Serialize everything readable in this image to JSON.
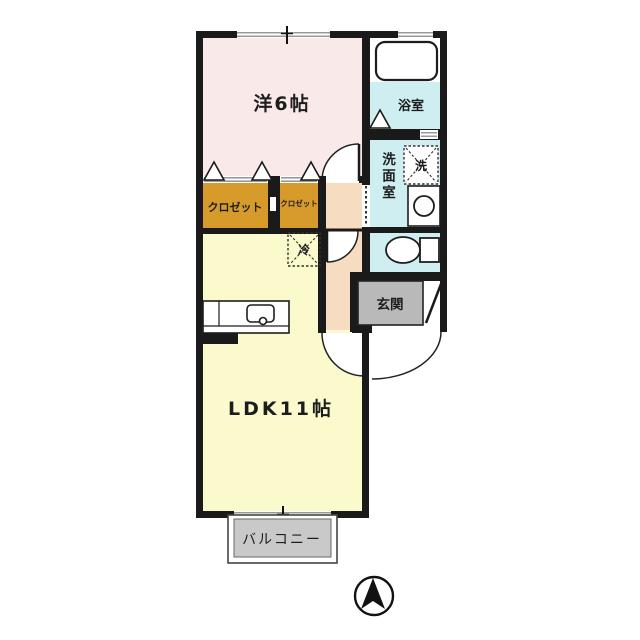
{
  "plan": {
    "labels": {
      "bedroom": "洋6帖",
      "ldk": "LDK11帖",
      "bathroom": "浴室",
      "washroom": "洗面室",
      "washer": "洗",
      "fridge": "冷",
      "closet_large": "クロゼット",
      "closet_small": "クロゼット",
      "genkan": "玄関",
      "balcony": "バルコニー"
    },
    "colors": {
      "wall": "#1a1a1a",
      "bedroom": "#f9e9e9",
      "ldk": "#fbfacd",
      "closet": "#d79b2b",
      "wet_room": "#cfeef2",
      "hallway": "#f6dcc1",
      "genkan": "#b9b9b9",
      "balcony": "#c9c9c9",
      "window_line": "#999999",
      "closet_text": "#3f3a05",
      "balcony_text": "#333333"
    }
  }
}
